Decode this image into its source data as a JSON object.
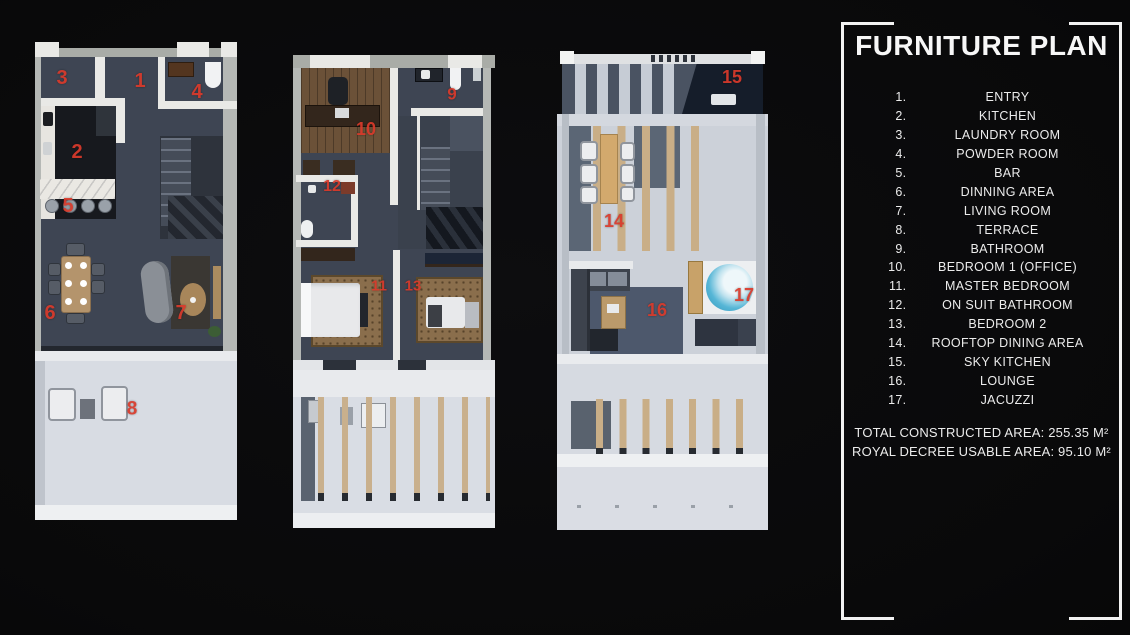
{
  "legend": {
    "title": "FURNITURE PLAN",
    "items": [
      {
        "num": "1.",
        "label": "ENTRY"
      },
      {
        "num": "2.",
        "label": "KITCHEN"
      },
      {
        "num": "3.",
        "label": "LAUNDRY ROOM"
      },
      {
        "num": "4.",
        "label": "POWDER ROOM"
      },
      {
        "num": "5.",
        "label": "BAR"
      },
      {
        "num": "6.",
        "label": "DINNING AREA"
      },
      {
        "num": "7.",
        "label": "LIVING ROOM"
      },
      {
        "num": "8.",
        "label": "TERRACE"
      },
      {
        "num": "9.",
        "label": "BATHROOM"
      },
      {
        "num": "10.",
        "label": "BEDROOM 1 (OFFICE)"
      },
      {
        "num": "11.",
        "label": "MASTER BEDROOM"
      },
      {
        "num": "12.",
        "label": "ON SUIT BATHROOM"
      },
      {
        "num": "13.",
        "label": "BEDROOM 2"
      },
      {
        "num": "14.",
        "label": "ROOFTOP DINING AREA"
      },
      {
        "num": "15.",
        "label": "SKY KITCHEN"
      },
      {
        "num": "16.",
        "label": "LOUNGE"
      },
      {
        "num": "17.",
        "label": "JACUZZI"
      }
    ],
    "total_area": "TOTAL CONSTRUCTED AREA: 255.35 M²",
    "usable_area": "ROYAL DECREE USABLE AREA: 95.10 M²"
  },
  "colors": {
    "label_red": "#d93a2b",
    "frame_white": "#f2f2f2"
  },
  "plans": [
    {
      "id": "ground-floor",
      "labels": [
        {
          "n": "3",
          "x": 27,
          "y": 38,
          "s": 20
        },
        {
          "n": "1",
          "x": 105,
          "y": 41,
          "s": 20
        },
        {
          "n": "4",
          "x": 162,
          "y": 52,
          "s": 20
        },
        {
          "n": "2",
          "x": 42,
          "y": 112,
          "s": 20
        },
        {
          "n": "5",
          "x": 33,
          "y": 166,
          "s": 20
        },
        {
          "n": "6",
          "x": 15,
          "y": 273,
          "s": 20
        },
        {
          "n": "7",
          "x": 146,
          "y": 273,
          "s": 20
        },
        {
          "n": "8",
          "x": 97,
          "y": 369,
          "s": 19
        }
      ]
    },
    {
      "id": "second-floor",
      "labels": [
        {
          "n": "9",
          "x": 164,
          "y": 39,
          "s": 17
        },
        {
          "n": "10",
          "x": 78,
          "y": 74,
          "s": 18
        },
        {
          "n": "12",
          "x": 44,
          "y": 132,
          "s": 16
        },
        {
          "n": "11",
          "x": 91,
          "y": 231,
          "s": 15
        },
        {
          "n": "13",
          "x": 125,
          "y": 231,
          "s": 15
        }
      ]
    },
    {
      "id": "roof-terrace",
      "labels": [
        {
          "n": "15",
          "x": 175,
          "y": 27,
          "s": 18
        },
        {
          "n": "14",
          "x": 57,
          "y": 171,
          "s": 18
        },
        {
          "n": "16",
          "x": 100,
          "y": 260,
          "s": 18
        },
        {
          "n": "17",
          "x": 187,
          "y": 245,
          "s": 18
        }
      ]
    }
  ]
}
